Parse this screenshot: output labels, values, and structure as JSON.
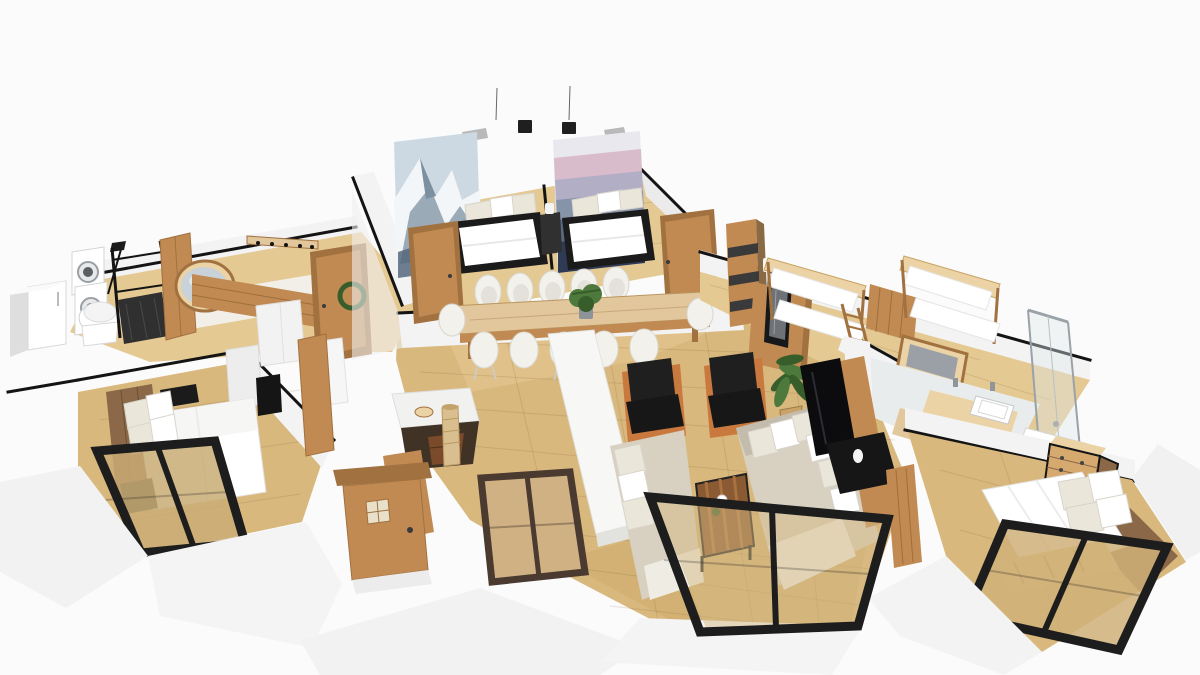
{
  "scene": {
    "title": "3D apartment floor plan render",
    "view": "3d-perspective-top",
    "palette": {
      "bg": "#fbfbfb",
      "outline": "#141414",
      "floor": "#d9b87e",
      "floor_light": "#e5c992",
      "floor_dark": "#c8a465",
      "wall_white": "#f3f3f3",
      "wall_light": "#ebebeb",
      "wall_gray": "#dedede",
      "wood": "#c18a52",
      "wood_dark": "#a17140",
      "wood_light": "#e3c79c",
      "wood_pale": "#ecd3a6",
      "wood_red": "#8a5a33",
      "wood_accent": "#8a6848",
      "oak_mid": "#d6a96e",
      "black": "#1b1b1b",
      "charcoal": "#303030",
      "white": "#ffffff",
      "offwhite": "#f3f1ec",
      "beige": "#d8d0c1",
      "beige_dark": "#c3bbac",
      "pillow": "#ebe6da",
      "orange": "#c9793d",
      "green": "#4d7a3c",
      "green_dark": "#375d2a",
      "marble": "#f1f1ef",
      "glass": "#c9d2d8",
      "metal": "#a3a9ad",
      "art_sky": "#ccd9e3",
      "art_snow": "#f2f6f9",
      "art_rock": "#7c90a0",
      "art_rock_dark": "#55697c",
      "art2_1": "#eae8ef",
      "art2_2": "#d9bccb",
      "art2_3": "#b2aec5",
      "art2_4": "#8694a9",
      "art2_5": "#596980",
      "art2_6": "#2f3b54"
    },
    "rooms": [
      {
        "name": "bedroom-twin-left",
        "furniture": [
          "mountain-photo-mural",
          "double-bed-black-frame",
          "white-pillows",
          "ceiling-lamp-square"
        ]
      },
      {
        "name": "bedroom-twin-right",
        "furniture": [
          "mountain-layers-mural",
          "double-bed-black-frame",
          "white-pillows",
          "ceiling-lamp-square",
          "black-nightstand",
          "white-vase"
        ]
      },
      {
        "name": "laundry-bath",
        "furniture": [
          "white-refrigerator",
          "stacked-washer-dryer",
          "toilet",
          "black-clothes-rack",
          "black-floor-lamp",
          "round-wood-mirror",
          "leaning-wood-panel",
          "wood-slat-wall",
          "wall-coat-rack"
        ]
      },
      {
        "name": "hallway",
        "furniture": [
          "wood-door-with-wreath"
        ]
      },
      {
        "name": "dining-room",
        "furniture": [
          "wood-dining-table",
          "white-shell-chairs",
          "potted-plant-centerpiece",
          "wood-door-left",
          "wood-door-right"
        ]
      },
      {
        "name": "kitchen",
        "furniture": [
          "white-island-counter",
          "marble-top-island",
          "wood-prep-counter",
          "black-cooktop",
          "rattan-floor-vase",
          "wood-stool",
          "dark-frame-window",
          "entry-door-glazed"
        ]
      },
      {
        "name": "bedroom-master-left",
        "furniture": [
          "double-bed-white",
          "black-foot-bench",
          "dark-wood-accent-wall",
          "white-wardrobes",
          "wall-tv",
          "wood-pillar-panel",
          "black-sliding-glass-door"
        ]
      },
      {
        "name": "living-room",
        "furniture": [
          "black-armchair-orange-frame-1",
          "black-armchair-orange-frame-2",
          "banana-plant",
          "beige-sofa-large",
          "beige-chaise-sofa",
          "striped-wood-coffee-table",
          "wood-tv-panel",
          "flatscreen-tv",
          "black-media-console",
          "wood-desk-chair",
          "black-sliding-glass-wall"
        ]
      },
      {
        "name": "kids-room",
        "furniture": [
          "wood-bookshelf",
          "wood-desk",
          "black-picture-frame",
          "desk-lamp",
          "bunk-bed-1",
          "bunk-bed-2",
          "ladder",
          "wood-slat-partition",
          "wood-frame-wall-tv"
        ]
      },
      {
        "name": "bathroom",
        "furniture": [
          "wood-vanity-counter",
          "white-sink",
          "chrome-faucets",
          "glass-shower-enclosure",
          "white-shower-tray",
          "wood-chest-of-drawers"
        ]
      },
      {
        "name": "bedroom-right",
        "furniture": [
          "pallet-bed-white-duvet",
          "white-pillows",
          "wood-chest-of-drawers",
          "dark-wood-accent-panel",
          "black-sliding-glass-doors"
        ]
      }
    ]
  }
}
